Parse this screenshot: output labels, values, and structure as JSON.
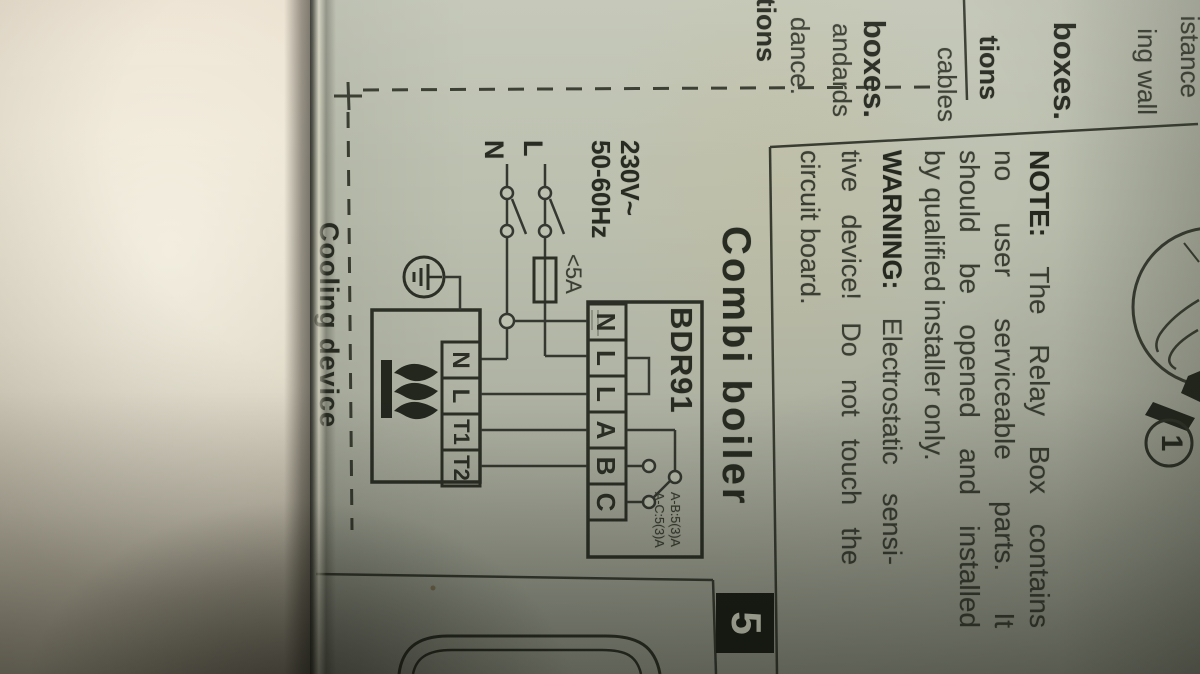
{
  "page": {
    "prev_column": {
      "fragments": [
        {
          "text": "istance"
        },
        {
          "text": "ing wall"
        },
        {
          "text": "boxes."
        },
        {
          "text": "tions"
        },
        {
          "text": "cables"
        },
        {
          "text": "boxes."
        },
        {
          "text": "andards"
        },
        {
          "text": "dance."
        },
        {
          "text": "tions"
        }
      ]
    },
    "note": {
      "label": "NOTE:",
      "line1_rest": "The Relay Box contains",
      "line2": "no user serviceable parts. It",
      "line3": "should be opened and installed",
      "line4": "by qualified installer only."
    },
    "warning": {
      "label": "WARNING:",
      "line1_rest": "Electrostatic sensi-",
      "line2": "tive device! Do not touch the",
      "line3": "circuit board."
    },
    "callout_number": "1",
    "section_number": "5",
    "diagram": {
      "title": "Combi boiler",
      "next_section_title": "Cooling device",
      "voltage": "230V~",
      "frequency": "50-60Hz",
      "live": "L",
      "neutral": "N",
      "fuse": "<5A",
      "relay_model": "BDR91",
      "relay_terminals": [
        "N",
        "L",
        "L",
        "A",
        "B",
        "C"
      ],
      "boiler_terminals": [
        "N",
        "L",
        "T1",
        "T2"
      ],
      "rating_line1": "A-B:5(3)A",
      "rating_line2": "A-C:5(3)A"
    },
    "colors": {
      "paper": "#bcc0af",
      "ink": "#373b30",
      "ink_bold": "#272b21",
      "badge_bg": "#1a1d16",
      "badge_text": "#d9dbc9"
    }
  }
}
